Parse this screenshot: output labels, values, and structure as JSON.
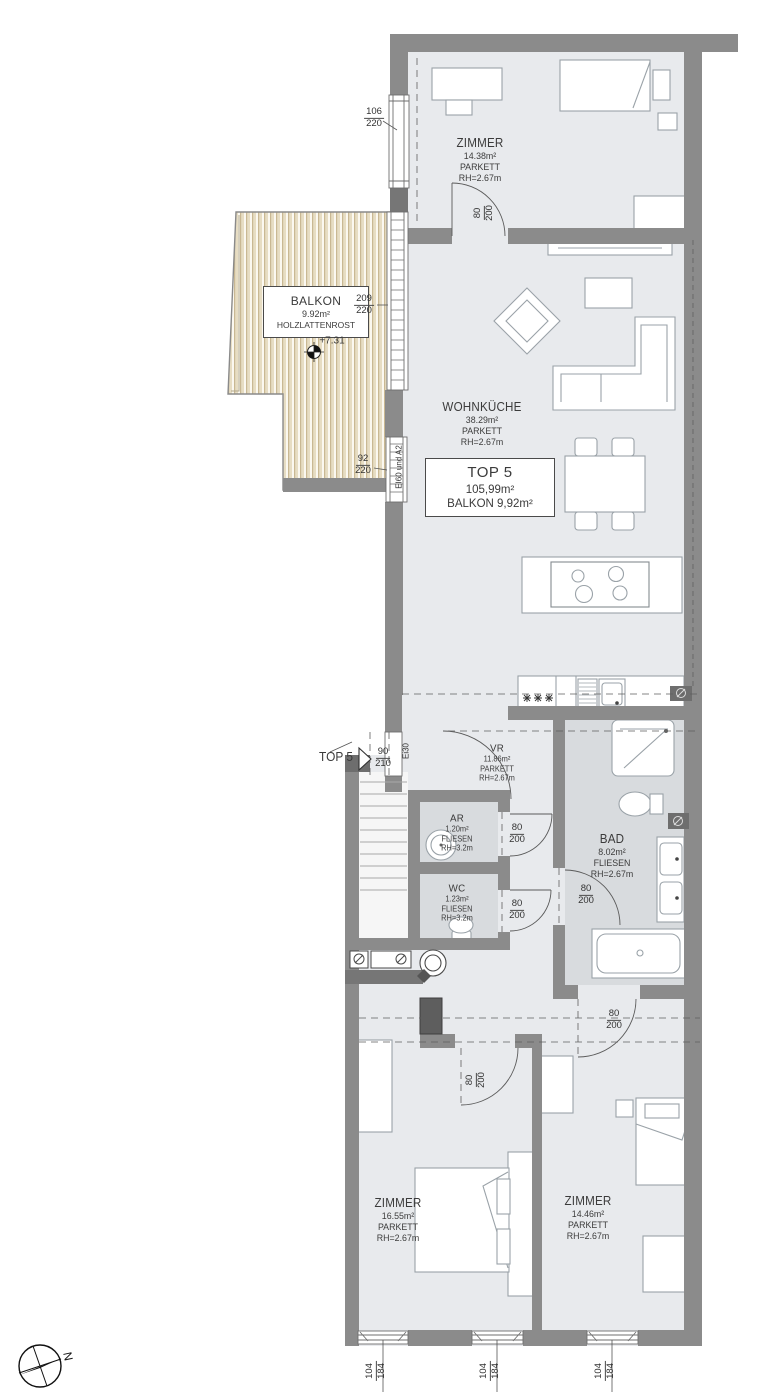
{
  "unit_box": {
    "title": "TOP 5",
    "area": "105,99m²",
    "balcony": "BALKON 9,92m²"
  },
  "rooms": {
    "zimmer_top": {
      "name": "ZIMMER",
      "area": "14.38m²",
      "floor": "PARKETT",
      "height": "RH=2.67m"
    },
    "wohnkueche": {
      "name": "WOHNKÜCHE",
      "area": "38.29m²",
      "floor": "PARKETT",
      "height": "RH=2.67m"
    },
    "vr": {
      "name": "VR",
      "area": "11.86m²",
      "floor": "PARKETT",
      "height": "RH=2.67m"
    },
    "ar": {
      "name": "AR",
      "area": "1.20m²",
      "floor": "FLIESEN",
      "height": "RH=3.2m"
    },
    "wc": {
      "name": "WC",
      "area": "1.23m²",
      "floor": "FLIESEN",
      "height": "RH=3.2m"
    },
    "bad": {
      "name": "BAD",
      "area": "8.02m²",
      "floor": "FLIESEN",
      "height": "RH=2.67m"
    },
    "zimmer_bottom_left": {
      "name": "ZIMMER",
      "area": "16.55m²",
      "floor": "PARKETT",
      "height": "RH=2.67m"
    },
    "zimmer_bottom_right": {
      "name": "ZIMMER",
      "area": "14.46m²",
      "floor": "PARKETT",
      "height": "RH=2.67m"
    }
  },
  "balcony": {
    "name": "BALKON",
    "area": "9.92m²",
    "surface": "HOLZLATTENROST",
    "level": "+7.31"
  },
  "entrance": {
    "unit": "TOP 5",
    "fire_rating": "Ei30"
  },
  "wall_rating": "EI60 und A2",
  "dims": {
    "window_top": {
      "w": "106",
      "h": "220"
    },
    "door_zimmer_top": {
      "w": "80",
      "h": "200"
    },
    "balcony_door": {
      "w": "209",
      "h": "220"
    },
    "window_mid": {
      "w": "92",
      "h": "220"
    },
    "entrance_door": {
      "w": "90",
      "h": "210"
    },
    "door_ar": {
      "w": "80",
      "h": "200"
    },
    "door_wc": {
      "w": "80",
      "h": "200"
    },
    "door_bad": {
      "w": "80",
      "h": "200"
    },
    "door_zimmer_br": {
      "w": "80",
      "h": "200"
    },
    "door_zimmer_bl": {
      "w": "80",
      "h": "200"
    },
    "window_b1": {
      "w": "104",
      "h": "184"
    },
    "window_b2": {
      "w": "104",
      "h": "184"
    },
    "window_b3": {
      "w": "104",
      "h": "184"
    }
  },
  "compass": {
    "north": "N"
  },
  "colors": {
    "wall": "#8b8b8b",
    "wall_dark": "#6e6e6e",
    "room_fill": "#e8eaed",
    "wet_fill": "#d8dbde",
    "balcony_fill": "#e7ddc3",
    "line": "#555555",
    "text": "#3b3b3b"
  }
}
